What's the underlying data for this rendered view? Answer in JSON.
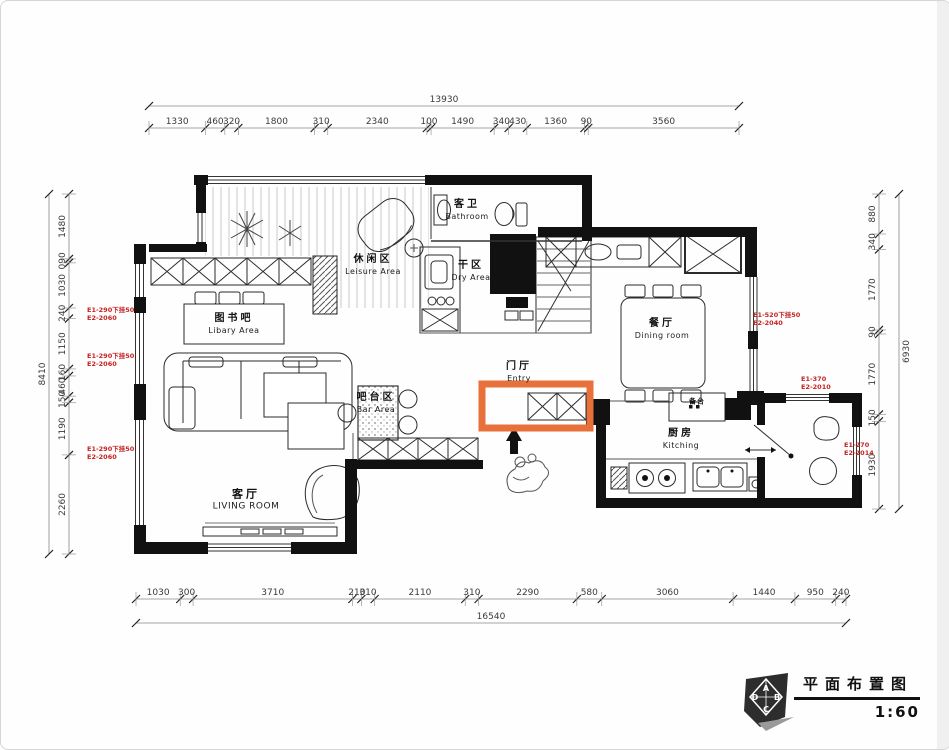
{
  "title": {
    "text": "平面布置图",
    "scale": "1:60",
    "compass": [
      "A",
      "B",
      "C",
      "D"
    ]
  },
  "rooms": [
    {
      "id": "leisure",
      "zh": "休闲区",
      "en": "Leisure Area"
    },
    {
      "id": "bathroom",
      "zh": "客卫",
      "en": "Bathroom"
    },
    {
      "id": "dry",
      "zh": "干区",
      "en": "Dry Area"
    },
    {
      "id": "dining",
      "zh": "餐厅",
      "en": "Dining room"
    },
    {
      "id": "library",
      "zh": "图书吧",
      "en": "Libary Area"
    },
    {
      "id": "entry",
      "zh": "门厅",
      "en": "Entry"
    },
    {
      "id": "bar",
      "zh": "吧台区",
      "en": "Bar Area"
    },
    {
      "id": "living",
      "zh": "客厅",
      "en": "LIVING ROOM"
    },
    {
      "id": "kitchen",
      "zh": "厨房",
      "en": "Kitching"
    },
    {
      "id": "prep",
      "zh": "备台",
      "en": ""
    }
  ],
  "dimensions": {
    "top": {
      "total": "13930",
      "segments": [
        "1330",
        "460",
        "320",
        "1800",
        "310",
        "2340",
        "100",
        "1490",
        "340",
        "430",
        "1360",
        "90",
        "3560"
      ]
    },
    "bottom": {
      "total": "16540",
      "segments": [
        "1030",
        "300",
        "3710",
        "210",
        "310",
        "2110",
        "310",
        "2290",
        "580",
        "3060",
        "1440",
        "950",
        "240"
      ]
    },
    "left": {
      "total": "8410",
      "segments": [
        "1480",
        "090",
        "1030",
        "240",
        "1150",
        "160",
        "460",
        "150",
        "1190",
        "2260"
      ]
    },
    "right": {
      "total": "6930",
      "segments": [
        "880",
        "340",
        "1770",
        "90",
        "1770",
        "150",
        "1930"
      ]
    }
  },
  "window_tags": [
    {
      "line1": "E1-290下挂50",
      "line2": "E2-2060"
    },
    {
      "line1": "E1-290下挂50",
      "line2": "E2-2060"
    },
    {
      "line1": "E1-290下挂50",
      "line2": "E2-2060"
    },
    {
      "line1": "E1-520下挂50",
      "line2": "E2-2040"
    },
    {
      "line1": "E1-370",
      "line2": "E2-2010"
    },
    {
      "line1": "E1-270",
      "line2": "E2-2014"
    }
  ],
  "colors": {
    "highlight": "#e8703a",
    "annotation": "#c42222",
    "wall": "#111111"
  }
}
